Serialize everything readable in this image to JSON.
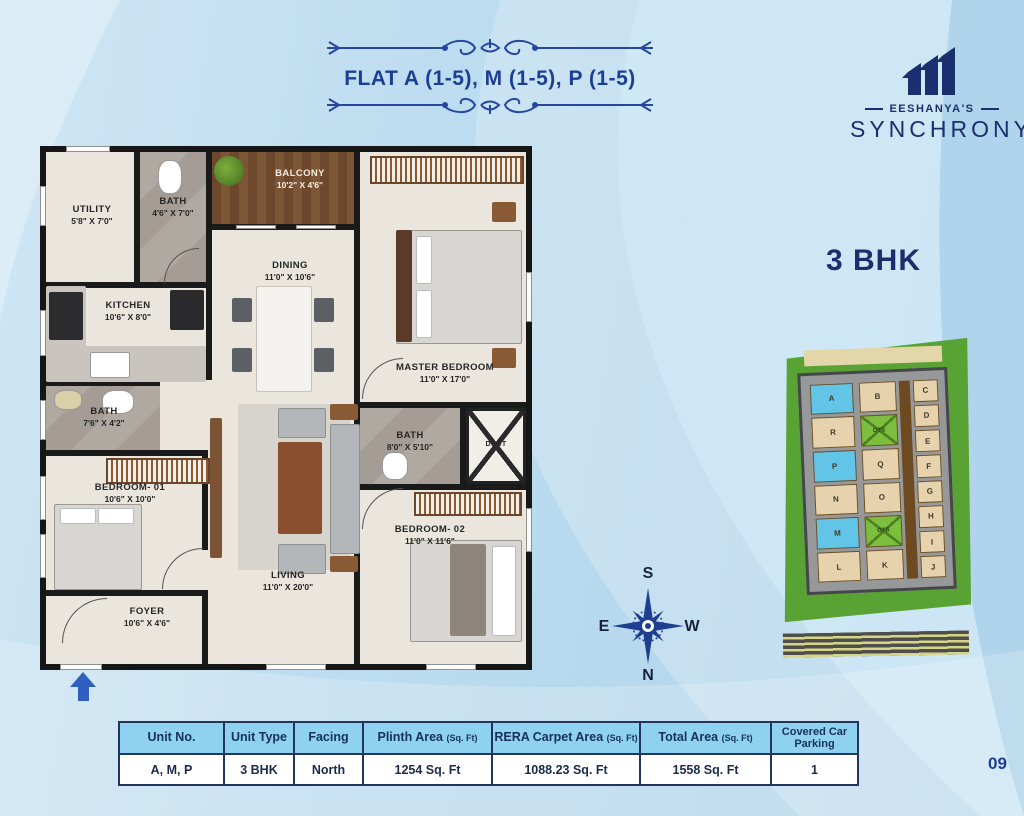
{
  "header": {
    "title": "FLAT A (1-5), M (1-5), P (1-5)",
    "logo": {
      "brand": "EESHANYA'S",
      "name": "SYNCHRONY"
    }
  },
  "unit_type_label": "3 BHK",
  "plan": {
    "rooms": [
      {
        "name": "UTILITY",
        "dims": "5'8\" X 7'0\""
      },
      {
        "name": "BATH",
        "dims": "4'6\" X 7'0\""
      },
      {
        "name": "BALCONY",
        "dims": "10'2\" X 4'6\""
      },
      {
        "name": "KITCHEN",
        "dims": "10'6\" X 8'0\""
      },
      {
        "name": "DINING",
        "dims": "11'0\" X 10'6\""
      },
      {
        "name": "MASTER BEDROOM",
        "dims": "11'0\" X 17'0\""
      },
      {
        "name": "BATH",
        "dims": "7'6\" X 4'2\""
      },
      {
        "name": "BATH",
        "dims": "8'0\" X 5'10\""
      },
      {
        "name": "DUCT",
        "dims": ""
      },
      {
        "name": "BEDROOM- 01",
        "dims": "10'6\" X 10'0\""
      },
      {
        "name": "LIVING",
        "dims": "11'0\" X 20'0\""
      },
      {
        "name": "BEDROOM- 02",
        "dims": "11'0\" X 11'6\""
      },
      {
        "name": "FOYER",
        "dims": "10'6\" X 4'6\""
      }
    ]
  },
  "compass": {
    "n": "N",
    "s": "S",
    "e": "E",
    "w": "W"
  },
  "keyplan": {
    "col_left": [
      "A",
      "R",
      "P",
      "N",
      "M",
      "L"
    ],
    "col_mid": [
      "B",
      "OTS",
      "Q",
      "O",
      "OTS",
      "K"
    ],
    "col_right": [
      "C",
      "D",
      "E",
      "F",
      "G",
      "H",
      "I",
      "J"
    ]
  },
  "table": {
    "headers": [
      {
        "label": "Unit No.",
        "sub": ""
      },
      {
        "label": "Unit Type",
        "sub": ""
      },
      {
        "label": "Facing",
        "sub": ""
      },
      {
        "label": "Plinth Area",
        "sub": "(Sq. Ft)"
      },
      {
        "label": "RERA Carpet Area",
        "sub": "(Sq. Ft)"
      },
      {
        "label": "Total Area",
        "sub": "(Sq. Ft)"
      },
      {
        "label": "Covered Car Parking",
        "sub": ""
      }
    ],
    "row": [
      "A, M, P",
      "3 BHK",
      "North",
      "1254 Sq. Ft",
      "1088.23 Sq. Ft",
      "1558 Sq. Ft",
      "1"
    ]
  },
  "page_number": "09",
  "colors": {
    "accent_navy": "#1c3f94",
    "table_header_blue": "#8ed2f0",
    "keyplan_green": "#58a334",
    "highlight_cyan": "#62c4e6",
    "background_blue": "#bddcef"
  }
}
